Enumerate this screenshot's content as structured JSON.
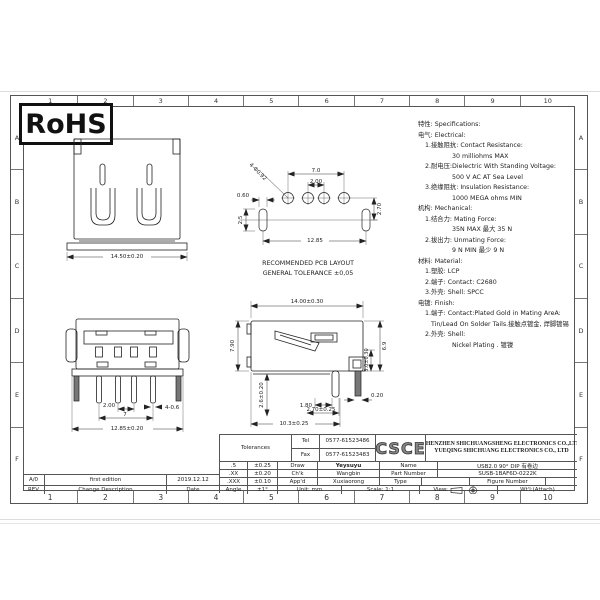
{
  "frame": {
    "cols": [
      "1",
      "2",
      "3",
      "4",
      "5",
      "6",
      "7",
      "8",
      "9",
      "10"
    ],
    "rows": [
      "A",
      "B",
      "C",
      "D",
      "E",
      "F"
    ]
  },
  "rohs_label": "RoHS",
  "specs": {
    "lines": [
      "特性: Specifications:",
      "电气: Electrical:",
      "1.接触阻抗: Contact Resistance:",
      "30 milliohms MAX",
      "2.耐电压:Dielectric With Standing Voltage:",
      "500 V AC AT Sea Level",
      "3.绝缘阻抗: Insulation Resistance:",
      "1000 MEGA ohms MIN",
      "机构: Mechanical:",
      "1.结合力: Mating Force:",
      "35N MAX 最大 35 N",
      "2.拔出力: Unmating Force:",
      "9 N MIN 最少 9 N",
      "材料: Material:",
      "1.塑胶: LCP",
      "2.端子: Contact: C2680",
      "3.外壳: Shell: SPCC",
      "电镀: Finish:",
      "1.端子: Contact:Plated Gold in Mating AreA:",
      "Tin/Lead On Solder Tails.接触点镀金, 焊脚镀锡",
      "2.外壳: Shell:",
      "Nickel Plating . 镀镍"
    ]
  },
  "views": {
    "front_top": {
      "overall_width": "14.50±0.20"
    },
    "pcb_layout": {
      "pitch_outer": "7.0",
      "pitch_inner": "2.00",
      "row_offset": "2.70",
      "pad_width": "0.60",
      "slot_height": "2.5",
      "hole_span": "12.85",
      "hole_callout": "4-Φ0.92",
      "caption_line1": "RECOMMENDED PCB LAYOUT",
      "caption_line2": "GENERAL TOLERANCE ±0,05"
    },
    "front_view": {
      "pin_pitch": "2.00",
      "pin_span": "7",
      "pin_callout": "4-0.6",
      "overall_width": "12.85±0.20"
    },
    "side_view": {
      "overall_length": "14.00±0.30",
      "face_height": "7.90",
      "height": "6.9",
      "leg_height": "3.0±0.30",
      "pin_depth": "2.6±0.20",
      "dim_a": "1.80",
      "dim_b": "2.70±0.25",
      "dim_c": "0.20",
      "footprint": "10.3±0.25"
    }
  },
  "title_block": {
    "tolerances_label": "Tolerances",
    "tel_label": "Tel",
    "tel_value": "0577-61523486",
    "fax_label": "Fax",
    "fax_value": "0577-61523483",
    "logo": "CSCE",
    "company_line1": "SHENZHEN SHICHUANGSHENG ELECTRONICS CO.,LTD",
    "company_line2": "YUEQING SHICHUANG ELECTRONICS CO., LTD",
    "rows": [
      {
        "digit": ".5",
        "tol": "±0.25",
        "role": "Draw",
        "person": "Yeysuyu",
        "field": "Name",
        "value": "USB2.0 90° DIP 有卷边"
      },
      {
        "digit": ".XX",
        "tol": "±0.20",
        "role": "Ch'k",
        "person": "Wangbin",
        "field": "Part Number",
        "value": "SUSB-1BAF6D-0222K"
      },
      {
        "digit": ".XXX",
        "tol": "±0.10",
        "role": "App'd",
        "person": "Xuxiaorong",
        "field": "Type",
        "value": "",
        "field2": "Figure Number",
        "value2": ""
      },
      {
        "digit": "Angle",
        "tol": "±1°",
        "unit": "Unit: mm",
        "scale": "Scale: 1:1",
        "view_label": "View:",
        "weight": "Wt'l:(Attach)"
      }
    ]
  },
  "revision_block": {
    "rows": [
      {
        "rev": "A/0",
        "description": "first edition",
        "date": "2019.12.12"
      },
      {
        "rev": "REV",
        "description": "Change Description",
        "date": "Date"
      }
    ]
  }
}
